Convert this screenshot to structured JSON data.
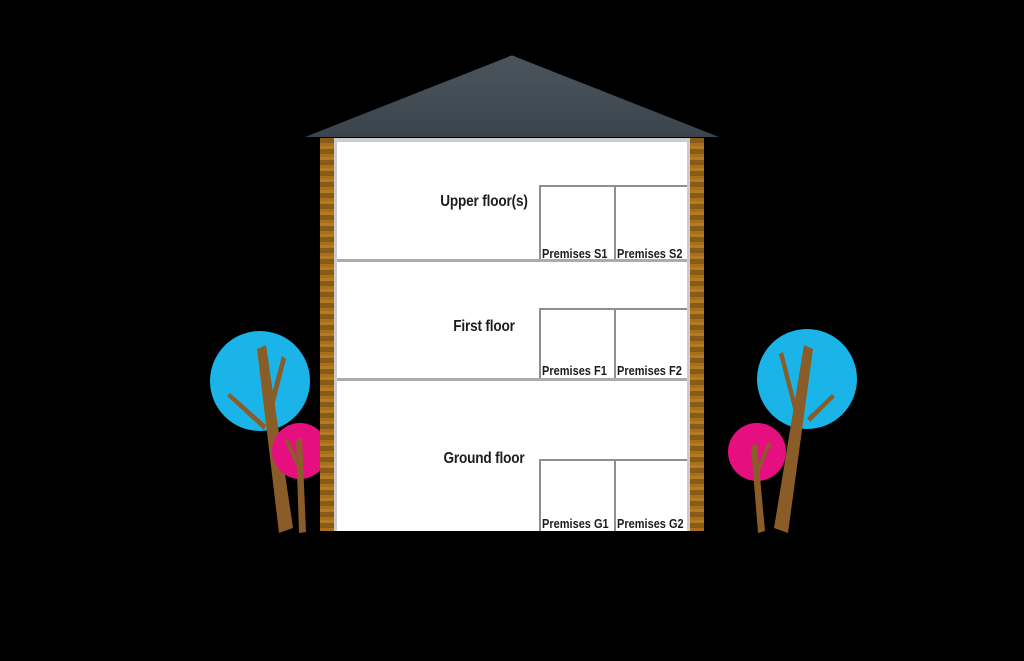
{
  "building": {
    "floors": [
      {
        "label": "Upper floor(s)",
        "premises": [
          "Premises S1",
          "Premises S2"
        ]
      },
      {
        "label": "First floor",
        "premises": [
          "Premises F1",
          "Premises F2"
        ]
      },
      {
        "label": "Ground floor",
        "premises": [
          "Premises G1",
          "Premises G2"
        ]
      }
    ]
  },
  "colors": {
    "background": "#000000",
    "roof_top": "#4a555d",
    "roof_bottom": "#3a444c",
    "brick_dark": "#8a5a17",
    "brick_mid": "#a9701c",
    "brick_light": "#b57b22",
    "interior": "#ffffff",
    "interior_border": "#cccccc",
    "floor_divider": "#ababab",
    "premises_border": "#8e8e8e",
    "text": "#1d1d1b",
    "tree_blue": "#1ab4e8",
    "tree_pink": "#e60f80",
    "trunk": "#8a5c28"
  },
  "icons": {
    "roof": "roof-icon",
    "tree_blue": "tree-blue-icon",
    "tree_pink": "tree-pink-icon"
  }
}
